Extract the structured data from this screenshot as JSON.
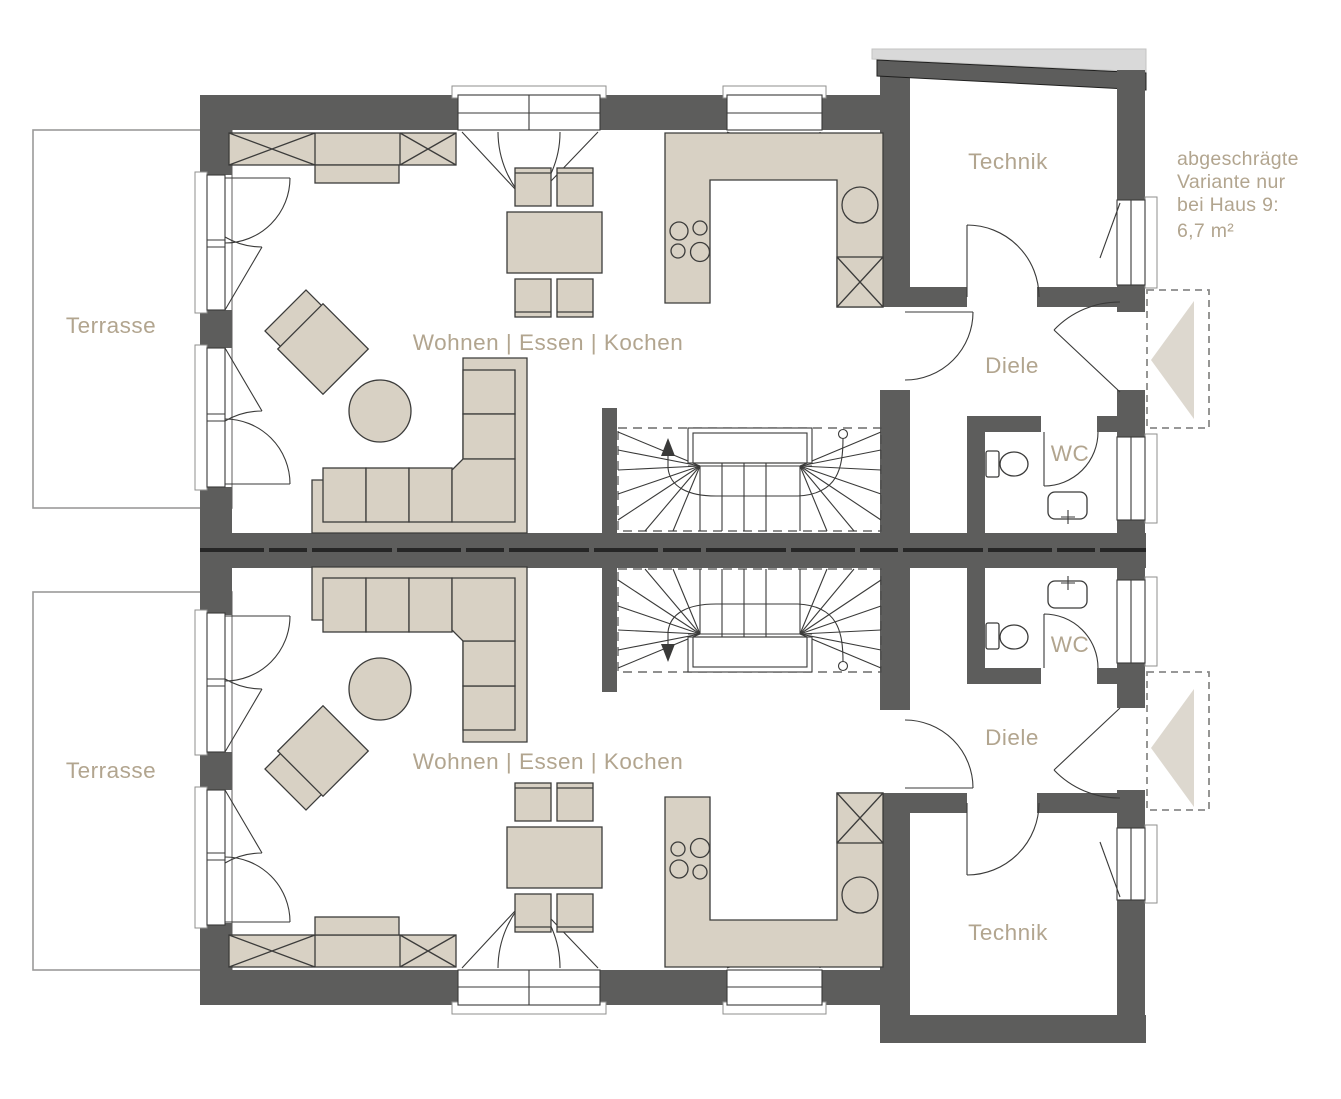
{
  "plan": {
    "type": "floor-plan",
    "units": [
      {
        "id": "upper-house",
        "terrace_label": "Terrasse",
        "living_label": "Wohnen | Essen | Kochen",
        "technik_label": "Technik",
        "hall_label": "Diele",
        "wc_label": "WC"
      },
      {
        "id": "lower-house",
        "terrace_label": "Terrasse",
        "living_label": "Wohnen | Essen | Kochen",
        "technik_label": "Technik",
        "hall_label": "Diele",
        "wc_label": "WC"
      }
    ],
    "annotation": {
      "line1": "abgeschrägte",
      "line2": "Variante nur",
      "line3": "bei Haus 9:",
      "line4": "6,7 m²"
    },
    "colors": {
      "wall": "#5d5d5c",
      "furniture": "#d8d1c4",
      "label": "#b2a58f",
      "roof_shadow": "#d9d9d9",
      "porch_arrow": "#ddd8cf"
    }
  }
}
